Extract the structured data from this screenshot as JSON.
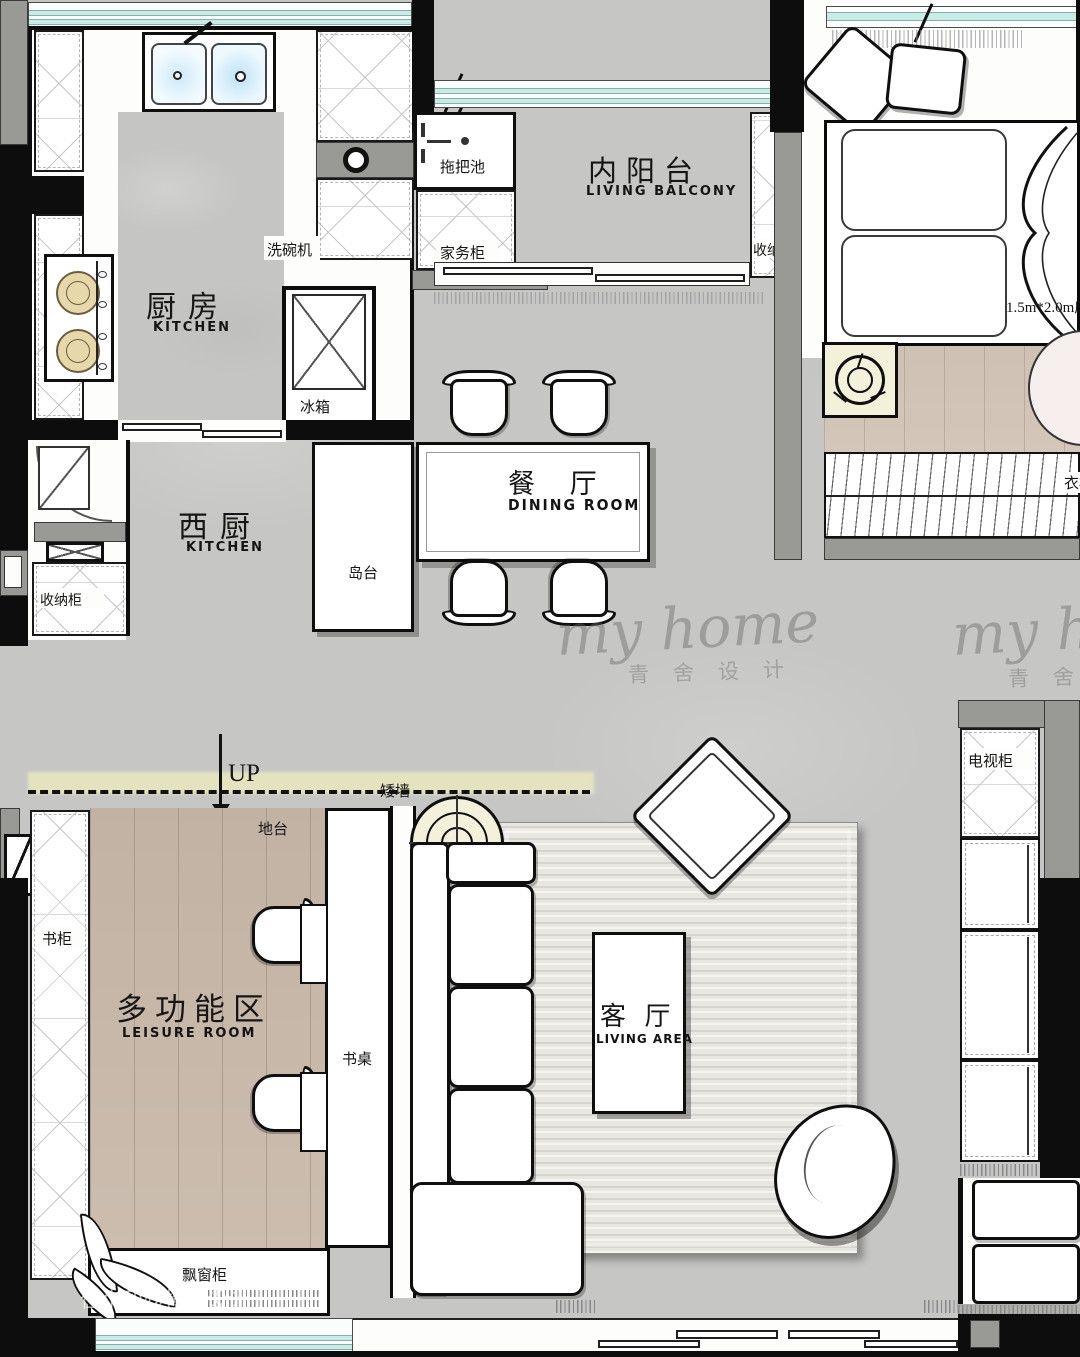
{
  "plan": {
    "rooms": {
      "kitchen": {
        "zh": "厨房",
        "en": "KITCHEN"
      },
      "living_balcony": {
        "zh": "内阳台",
        "en": "LIVING BALCONY"
      },
      "west_kitchen": {
        "zh": "西厨",
        "en": "KITCHEN"
      },
      "dining_room": {
        "zh": "餐 厅",
        "en": "DINING ROOM"
      },
      "leisure_room": {
        "zh": "多功能区",
        "en": "LEISURE ROOM"
      },
      "living_area": {
        "zh": "客 厅",
        "en": "LIVING AREA"
      }
    },
    "fixtures": {
      "mop_sink": "拖把池",
      "dishwasher": "洗碗机",
      "fridge": "冰箱",
      "housework_cabinet": "家务柜",
      "balcony_storage_cabinet": "收纳柜",
      "entry_storage_cabinet": "收纳柜",
      "island": "岛台",
      "bed_size": "1.5m*2.0m床",
      "wardrobe": "衣柜",
      "bookcase": "书柜",
      "platform": "地台",
      "low_wall": "矮墙",
      "up": "UP",
      "desk": "书桌",
      "bay_window_cabinet": "飘窗柜",
      "tv_cabinet": "电视柜"
    },
    "watermark": {
      "script": "my home",
      "script_sub": "青舍设计",
      "credit": "住小帮@橙子设计"
    },
    "colors": {
      "floor_gray": "#c6c7c4",
      "wood": "#cfc1b3",
      "wall_black": "#0d0d0d",
      "wall_gray": "#999996",
      "window_teal": "#c9ebe6",
      "burner_tan": "#e7d8ab",
      "lamp_cream": "#f3f1da",
      "highlight_yellow": "#e9e8c0"
    }
  }
}
